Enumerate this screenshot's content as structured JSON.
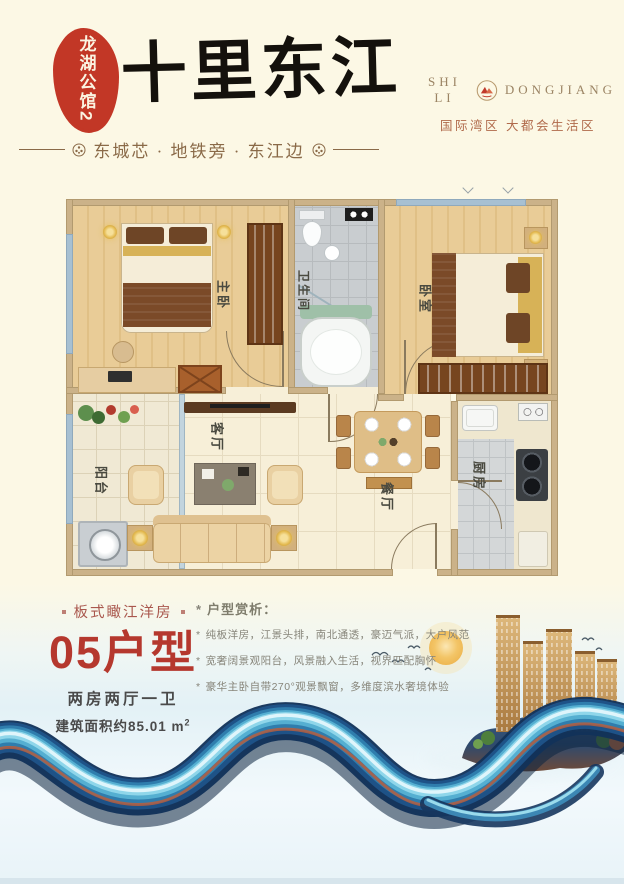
{
  "header": {
    "seal": "龙湖公馆2",
    "title": "十里东江",
    "brand_left": "SHI LI",
    "brand_right": "DONGJIANG",
    "brand_subtitle": "国际湾区  大都会生活区",
    "tagline": "东城芯 · 地铁旁 · 东江边"
  },
  "floorplan": {
    "rooms": {
      "master_bedroom": "主卧",
      "bathroom": "卫生间",
      "bedroom": "卧室",
      "balcony": "阳台",
      "living_room": "客厅",
      "dining_room": "餐厅",
      "kitchen": "厨房"
    }
  },
  "info": {
    "series": "板式瞰江洋房",
    "unit": "05户型",
    "layout": "两房两厅一卫",
    "area": "建筑面积约85.01 m",
    "area_sup": "2",
    "analysis_title": "户型赏析：",
    "bullet": "*",
    "points": [
      "纯板洋房，江景头排，南北通透，豪迈气派，大户风范",
      "宽奢阔景观阳台，风景融入生活，视界匹配胸怀",
      "豪华主卧自带270°观景飘窗，多维度滨水奢境体验"
    ]
  },
  "colors": {
    "seal_red": "#C23726",
    "unit_red": "#B5382E",
    "brand_tan": "#9B8464",
    "subtitle_brown": "#B06A4B",
    "wall_tan": "#CBB289",
    "ribbon_navy": "#12325A",
    "building_gold": "#C79E63"
  }
}
